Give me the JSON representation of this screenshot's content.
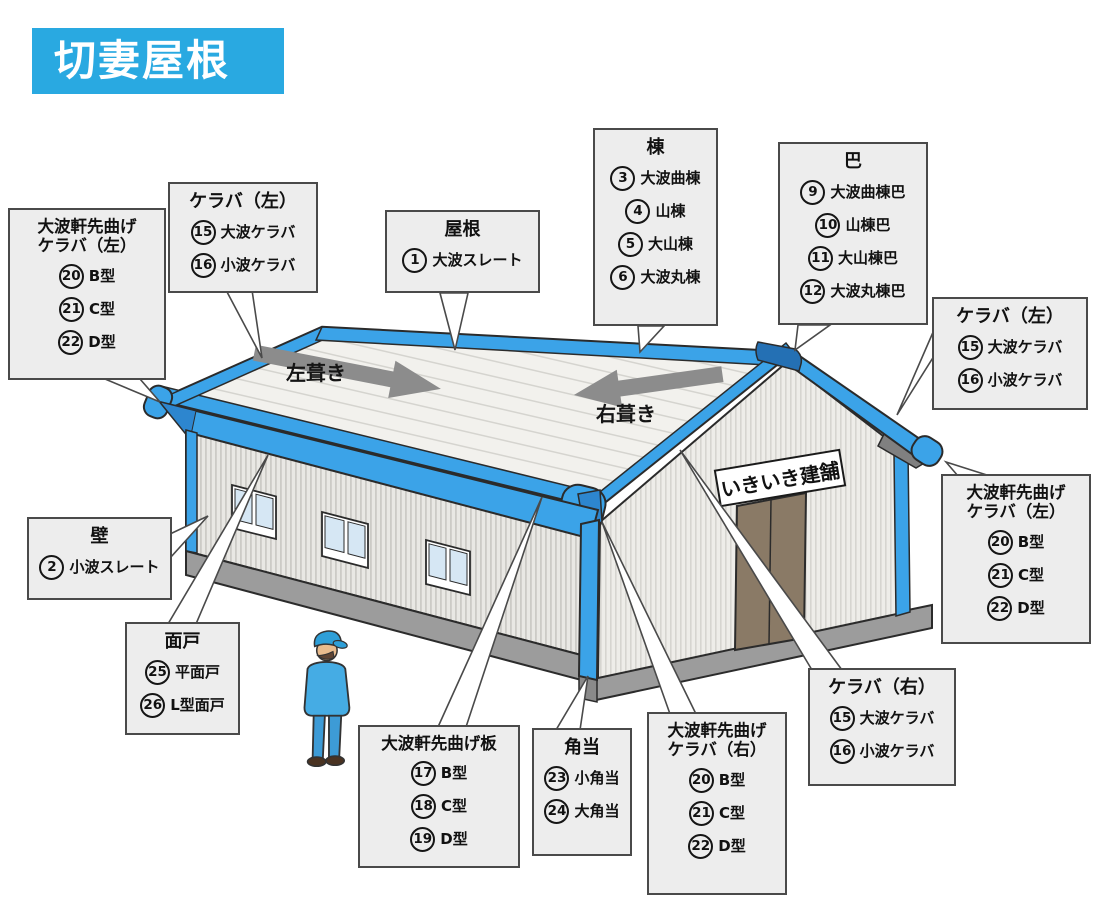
{
  "title": "切妻屋根",
  "colors": {
    "accent_blue": "#29A9E1",
    "trim_blue": "#3BA3E8",
    "trim_blue_dark": "#2470B4",
    "box_bg": "#EDEDED",
    "box_border": "#4A4A4A",
    "base_gray": "#9C9C9C",
    "door_brown": "#8A7A66"
  },
  "building": {
    "sign_text": "いきいき建舗",
    "roof_left_label": "左葺き",
    "roof_right_label": "右葺き"
  },
  "callouts": [
    {
      "title_lines": [
        "大波軒先曲げ",
        "ケラバ（左）"
      ],
      "items": [
        {
          "num": "20",
          "label": "B型"
        },
        {
          "num": "21",
          "label": "C型"
        },
        {
          "num": "22",
          "label": "D型"
        }
      ]
    },
    {
      "title_lines": [
        "ケラバ（左）"
      ],
      "items": [
        {
          "num": "15",
          "label": "大波ケラバ"
        },
        {
          "num": "16",
          "label": "小波ケラバ"
        }
      ]
    },
    {
      "title_lines": [
        "屋根"
      ],
      "items": [
        {
          "num": "1",
          "label": "大波スレート"
        }
      ]
    },
    {
      "title_lines": [
        "棟"
      ],
      "items": [
        {
          "num": "3",
          "label": "大波曲棟"
        },
        {
          "num": "4",
          "label": "山棟"
        },
        {
          "num": "5",
          "label": "大山棟"
        },
        {
          "num": "6",
          "label": "大波丸棟"
        }
      ]
    },
    {
      "title_lines": [
        "巴"
      ],
      "items": [
        {
          "num": "9",
          "label": "大波曲棟巴"
        },
        {
          "num": "10",
          "label": "山棟巴"
        },
        {
          "num": "11",
          "label": "大山棟巴"
        },
        {
          "num": "12",
          "label": "大波丸棟巴"
        }
      ]
    },
    {
      "title_lines": [
        "ケラバ（左）"
      ],
      "items": [
        {
          "num": "15",
          "label": "大波ケラバ"
        },
        {
          "num": "16",
          "label": "小波ケラバ"
        }
      ]
    },
    {
      "title_lines": [
        "大波軒先曲げ",
        "ケラバ（左）"
      ],
      "items": [
        {
          "num": "20",
          "label": "B型"
        },
        {
          "num": "21",
          "label": "C型"
        },
        {
          "num": "22",
          "label": "D型"
        }
      ]
    },
    {
      "title_lines": [
        "壁"
      ],
      "items": [
        {
          "num": "2",
          "label": "小波スレート"
        }
      ]
    },
    {
      "title_lines": [
        "面戸"
      ],
      "items": [
        {
          "num": "25",
          "label": "平面戸"
        },
        {
          "num": "26",
          "label": "L型面戸"
        }
      ]
    },
    {
      "title_lines": [
        "大波軒先曲げ板"
      ],
      "items": [
        {
          "num": "17",
          "label": "B型"
        },
        {
          "num": "18",
          "label": "C型"
        },
        {
          "num": "19",
          "label": "D型"
        }
      ]
    },
    {
      "title_lines": [
        "角当"
      ],
      "items": [
        {
          "num": "23",
          "label": "小角当"
        },
        {
          "num": "24",
          "label": "大角当"
        }
      ]
    },
    {
      "title_lines": [
        "大波軒先曲げ",
        "ケラバ（右）"
      ],
      "items": [
        {
          "num": "20",
          "label": "B型"
        },
        {
          "num": "21",
          "label": "C型"
        },
        {
          "num": "22",
          "label": "D型"
        }
      ]
    },
    {
      "title_lines": [
        "ケラバ（右）"
      ],
      "items": [
        {
          "num": "15",
          "label": "大波ケラバ"
        },
        {
          "num": "16",
          "label": "小波ケラバ"
        }
      ]
    }
  ]
}
